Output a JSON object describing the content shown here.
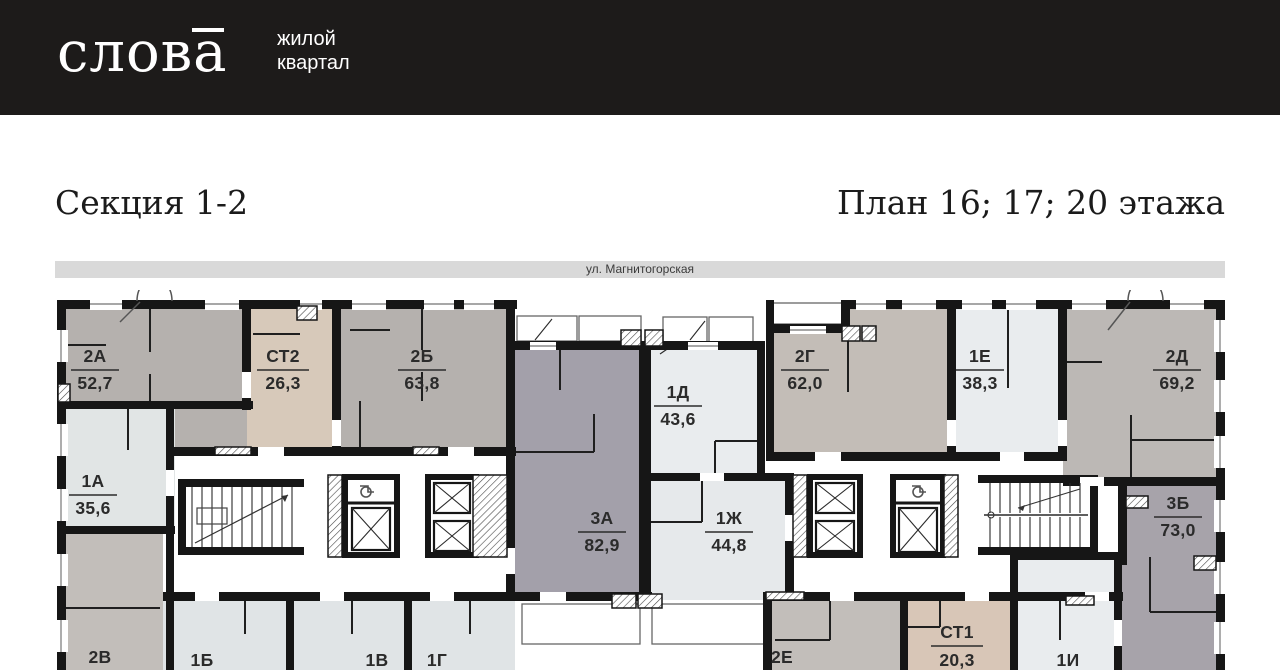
{
  "header": {
    "brand": "слова",
    "tagline_line1": "жилой",
    "tagline_line2": "квартал"
  },
  "titles": {
    "section": "Секция 1-2",
    "plan": "План 16; 17; 20 этажа"
  },
  "street": {
    "label": "ул. Магнитогорская"
  },
  "plan": {
    "units": [
      {
        "name": "2А",
        "area": "52,7",
        "color": "#b5b1ae"
      },
      {
        "name": "СТ2",
        "area": "26,3",
        "color": "#d7c9ba"
      },
      {
        "name": "2Б",
        "area": "63,8",
        "color": "#b5b1ae"
      },
      {
        "name": "1Д",
        "area": "43,6",
        "color": "#e9ecee"
      },
      {
        "name": "2Г",
        "area": "62,0",
        "color": "#c3bdb7"
      },
      {
        "name": "1Е",
        "area": "38,3",
        "color": "#e9ecee"
      },
      {
        "name": "2Д",
        "area": "69,2",
        "color": "#bcb8b5"
      },
      {
        "name": "1А",
        "area": "35,6",
        "color": "#e1e5e5"
      },
      {
        "name": "3А",
        "area": "82,9",
        "color": "#a3a0aa"
      },
      {
        "name": "1Ж",
        "area": "44,8",
        "color": "#e6e9eb"
      },
      {
        "name": "3Б",
        "area": "73,0",
        "color": "#a7a3aa"
      },
      {
        "name": "2В",
        "area": "",
        "color": "#c2beba"
      },
      {
        "name": "1Б",
        "area": "",
        "color": "#e0e4e6"
      },
      {
        "name": "1В",
        "area": "",
        "color": "#e0e4e6"
      },
      {
        "name": "1Г",
        "area": "",
        "color": "#e0e4e6"
      },
      {
        "name": "2Е",
        "area": "",
        "color": "#c2beba"
      },
      {
        "name": "СТ1",
        "area": "20,3",
        "color": "#d8c6b7"
      },
      {
        "name": "1И",
        "area": "",
        "color": "#e9ecee"
      }
    ]
  }
}
